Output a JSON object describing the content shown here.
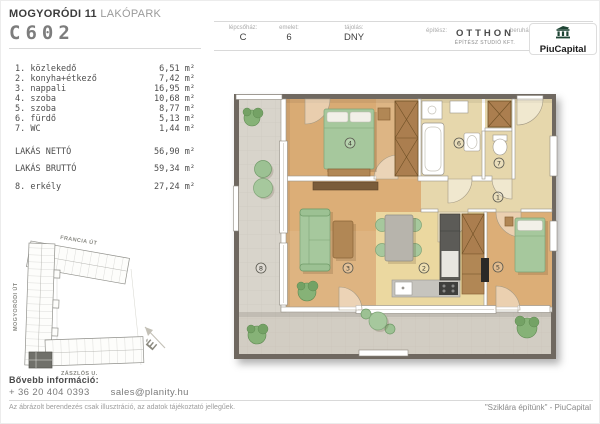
{
  "header": {
    "project": {
      "bold": "MOGYORÓDI 11",
      "light": "LAKÓPARK"
    },
    "unit_code": "C602",
    "fields": [
      {
        "label": "lépcsőház:",
        "value": "C"
      },
      {
        "label": "emelet:",
        "value": "6"
      },
      {
        "label": "tájolás:",
        "value": "DNY"
      }
    ],
    "architect": {
      "label": "építész:",
      "name": "OTTHON",
      "subtitle": "ÉPÍTÉSZ STUDIÓ KFT."
    },
    "developer": {
      "label": "beruházó:",
      "name": "PiuCapital"
    }
  },
  "room_list": {
    "rooms": [
      {
        "label": "1. közlekedő",
        "area": "6,51"
      },
      {
        "label": "2. konyha+étkező",
        "area": "7,42"
      },
      {
        "label": "3. nappali",
        "area": "16,95"
      },
      {
        "label": "4. szoba",
        "area": "10,68"
      },
      {
        "label": "5. szoba",
        "area": "8,77"
      },
      {
        "label": "6. fürdő",
        "area": "5,13"
      },
      {
        "label": "7. WC",
        "area": "1,44"
      }
    ],
    "totals": [
      {
        "label": "LAKÁS NETTÓ",
        "area": "56,90"
      },
      {
        "label": "LAKÁS BRUTTÓ",
        "area": "59,34"
      }
    ],
    "balcony": {
      "label": "8. erkély",
      "area": "27,24"
    },
    "unit": "m²"
  },
  "floor_plan": {
    "labels": [
      {
        "n": "1",
        "x": 292,
        "y": 116
      },
      {
        "n": "2",
        "x": 218,
        "y": 187
      },
      {
        "n": "3",
        "x": 142,
        "y": 187
      },
      {
        "n": "4",
        "x": 144,
        "y": 62
      },
      {
        "n": "5",
        "x": 292,
        "y": 186
      },
      {
        "n": "6",
        "x": 253,
        "y": 62
      },
      {
        "n": "7",
        "x": 293,
        "y": 82
      },
      {
        "n": "8",
        "x": 55,
        "y": 187
      }
    ]
  },
  "site_map": {
    "streets": {
      "top": "FRANCIA ÚT",
      "left": "MOGYORÓDI ÚT",
      "bottom": "ZÁSZLÓS U."
    },
    "north": "É"
  },
  "footer": {
    "info_label": "Bővebb információ:",
    "phone": "+ 36 20 404 0393",
    "email": "sales@planity.hu",
    "disclaimer": "Az ábrázolt berendezés csak illusztráció, az adatok tájékoztató jellegűek.",
    "slogan": "\"Sziklára építünk\" - PiuCapital"
  }
}
